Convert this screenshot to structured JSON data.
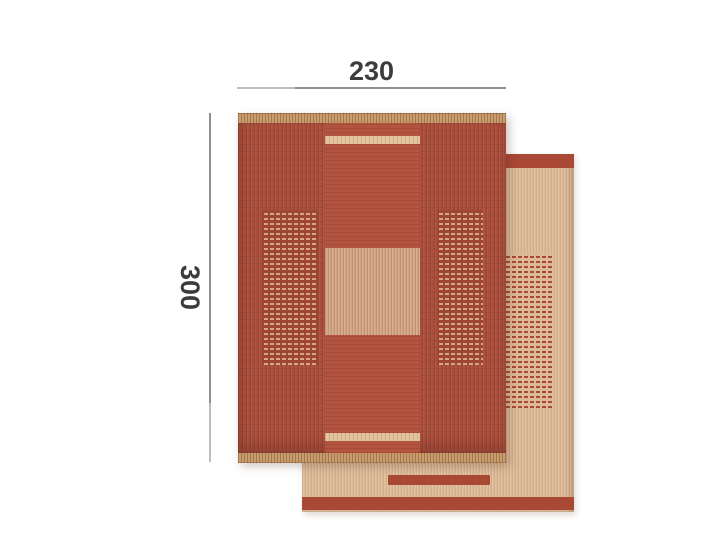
{
  "dimensions": {
    "width": "230",
    "height": "300"
  },
  "rugs": {
    "front": "red-patterned-rug-front-face",
    "back": "beige-rug-reverse-face"
  },
  "colors": {
    "dim_line": "#8f8f8f",
    "dim_text": "#3c3c3c",
    "front_red": "#ab4f3c",
    "front_red_deep": "#9d4634",
    "center_red": "#b2543f",
    "fringe": "#c99c6d",
    "cream": "#e2c59c",
    "square_beige": "#d2a485",
    "checker_light": "#d5a687",
    "back_beige": "#dcba97",
    "back_red": "#aa4836"
  }
}
